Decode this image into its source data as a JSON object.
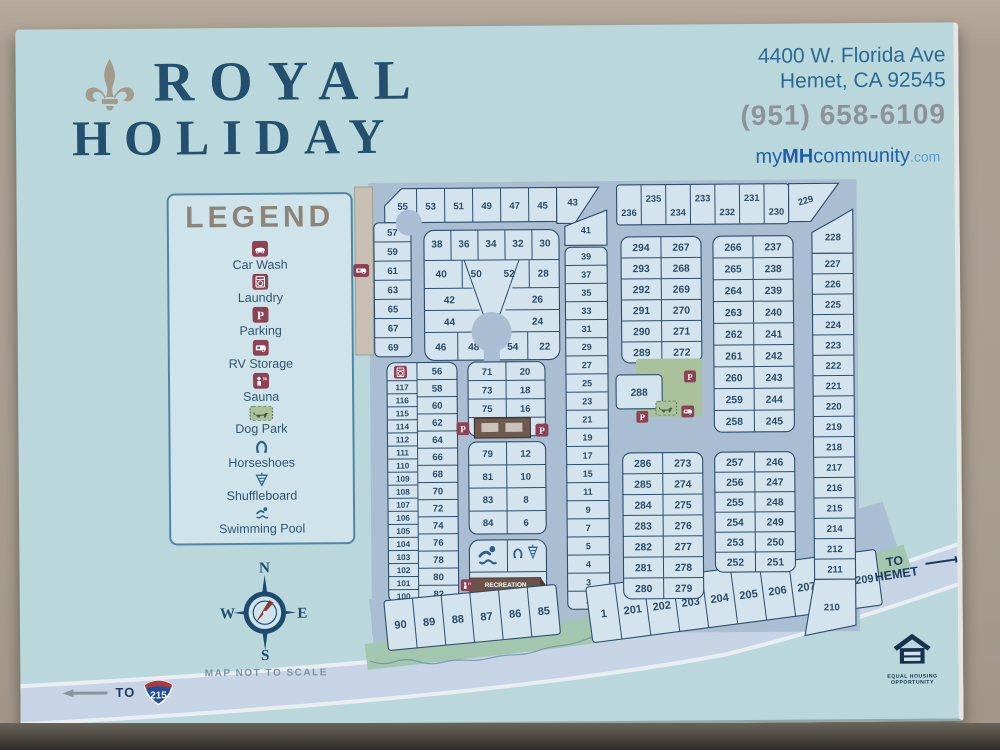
{
  "header": {
    "brand_line1": "ROYAL",
    "brand_line2": "HOLIDAY",
    "address_line1": "4400 W. Florida Ave",
    "address_line2": "Hemet, CA 92545",
    "phone": "(951) 658-6109",
    "website": {
      "my": "my",
      "mh": "MH",
      "community": "community",
      "com": ".com"
    }
  },
  "legend": {
    "title": "LEGEND",
    "items": [
      {
        "icon": "car-wash",
        "label": "Car Wash"
      },
      {
        "icon": "laundry",
        "label": "Laundry"
      },
      {
        "icon": "parking",
        "label": "Parking"
      },
      {
        "icon": "rv",
        "label": "RV Storage"
      },
      {
        "icon": "sauna",
        "label": "Sauna"
      },
      {
        "icon": "dog-park",
        "label": "Dog Park"
      },
      {
        "icon": "horseshoe",
        "label": "Horseshoes"
      },
      {
        "icon": "shuffleboard",
        "label": "Shuffleboard"
      },
      {
        "icon": "pool",
        "label": "Swimming Pool"
      }
    ]
  },
  "compass": {
    "n": "N",
    "e": "E",
    "s": "S",
    "w": "W"
  },
  "scale_note": "MAP NOT TO SCALE",
  "roads": {
    "to_label": "TO",
    "shield": "215",
    "to_hemet": "TO HEMET"
  },
  "equal_housing": [
    "EQUAL HOUSING",
    "OPPORTUNITY"
  ],
  "map": {
    "recreation_hall": "RECREATION HALL",
    "left_block": {
      "top_row": [
        "55",
        "53",
        "51",
        "49",
        "47",
        "45"
      ],
      "lot_43": "43",
      "lot_41": "41",
      "left_col": [
        "57",
        "59",
        "61",
        "63",
        "65",
        "67",
        "69"
      ],
      "right_col": [
        "39",
        "37",
        "35",
        "33",
        "31",
        "29",
        "27",
        "25",
        "23",
        "21",
        "19",
        "17",
        "15",
        "11",
        "9",
        "7",
        "5",
        "4",
        "3",
        "2"
      ],
      "inner_row1": [
        "38",
        "36",
        "34",
        "32",
        "30"
      ],
      "inner_row2": [
        "40",
        "50",
        "52",
        "28"
      ],
      "inner_row3": [
        "42",
        "26"
      ],
      "inner_row4": [
        "44",
        "24"
      ],
      "inner_row5": [
        "46",
        "48",
        "54",
        "22"
      ]
    },
    "mid_left_block": {
      "left_col": [
        "117",
        "116",
        "115",
        "114",
        "112",
        "111",
        "110",
        "109",
        "108",
        "107",
        "106",
        "105",
        "104",
        "103",
        "102",
        "101",
        "100"
      ],
      "right_col": [
        "56",
        "58",
        "60",
        "62",
        "64",
        "66",
        "68",
        "70",
        "72",
        "74",
        "76",
        "78",
        "80",
        "82"
      ]
    },
    "mid_block": {
      "upper_left": [
        "71",
        "73",
        "75",
        "77"
      ],
      "upper_right": [
        "20",
        "18",
        "16",
        "14"
      ],
      "lower_left": [
        "79",
        "81",
        "83",
        "84"
      ],
      "lower_right": [
        "12",
        "10",
        "8",
        "6"
      ]
    },
    "bottom_left_row": [
      "90",
      "89",
      "88",
      "87",
      "86",
      "85"
    ],
    "bottom_right_row": [
      "1",
      "201",
      "202",
      "203",
      "204",
      "205",
      "206",
      "207",
      "208",
      "209"
    ],
    "right_block": {
      "top_row": [
        "236",
        "235",
        "234",
        "233",
        "232",
        "231",
        "230"
      ],
      "lot_229": "229",
      "far_right_col": [
        "228",
        "227",
        "226",
        "225",
        "224",
        "223",
        "222",
        "221",
        "220",
        "219",
        "218",
        "217",
        "216",
        "215",
        "214",
        "212",
        "211",
        "210"
      ],
      "lot_288": "288",
      "block_a": [
        [
          "294",
          "267"
        ],
        [
          "293",
          "268"
        ],
        [
          "292",
          "269"
        ],
        [
          "291",
          "270"
        ],
        [
          "290",
          "271"
        ],
        [
          "289",
          "272"
        ]
      ],
      "block_b": [
        [
          "266",
          "237"
        ],
        [
          "265",
          "238"
        ],
        [
          "264",
          "239"
        ],
        [
          "263",
          "240"
        ],
        [
          "262",
          "241"
        ],
        [
          "261",
          "242"
        ],
        [
          "260",
          "243"
        ],
        [
          "259",
          "244"
        ],
        [
          "258",
          "245"
        ]
      ],
      "block_c": [
        [
          "286",
          "273"
        ],
        [
          "285",
          "274"
        ],
        [
          "284",
          "275"
        ],
        [
          "283",
          "276"
        ],
        [
          "282",
          "277"
        ],
        [
          "281",
          "278"
        ],
        [
          "280",
          "279"
        ]
      ],
      "block_d": [
        [
          "257",
          "246"
        ],
        [
          "256",
          "247"
        ],
        [
          "255",
          "248"
        ],
        [
          "254",
          "249"
        ],
        [
          "253",
          "250"
        ],
        [
          "252",
          "251"
        ]
      ]
    }
  },
  "colors": {
    "sign": "#bad8dc",
    "street": "#a9bdd3",
    "lot": "#d4e4ef",
    "outline": "#2e4d6b",
    "maroon": "#8e4152",
    "legend_green": "#a9c29b",
    "navy": "#1d4b70",
    "banner_brown": "#6b5347",
    "strip_tan": "#c6bfb2",
    "road": "#c7d4e6",
    "greenery": "#a3c7ae"
  }
}
